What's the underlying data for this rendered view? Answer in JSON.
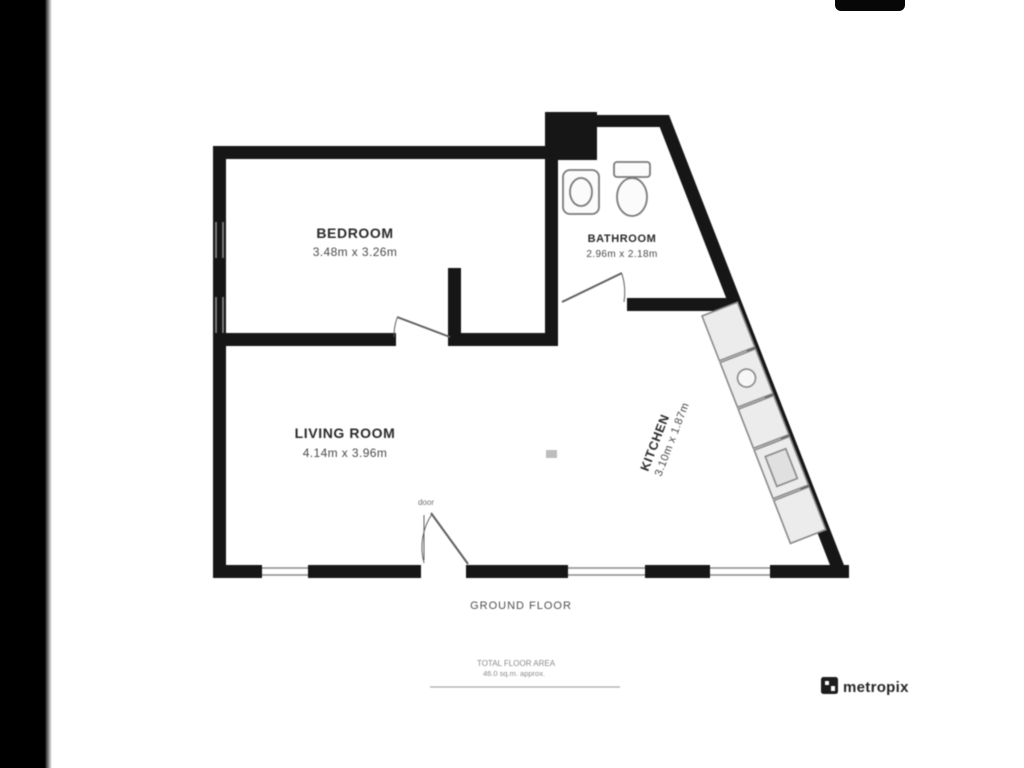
{
  "floorplan": {
    "rooms": [
      {
        "name": "BEDROOM",
        "dimensions": "3.48m x 3.26m"
      },
      {
        "name": "BATHROOM",
        "dimensions": "2.96m x 2.18m"
      },
      {
        "name": "LIVING ROOM",
        "dimensions": "4.14m x 3.96m"
      },
      {
        "name": "KITCHEN",
        "dimensions": "3.10m x 1.87m"
      }
    ],
    "door_label": "door",
    "floor_label": "GROUND FLOOR",
    "area_note_line1": "TOTAL FLOOR AREA",
    "area_note_line2": "46.0 sq.m. approx.",
    "brand": "metropix"
  },
  "colors": {
    "wall": "#161616",
    "fixture_line": "#7a7a7a",
    "window_line": "#8c8c8c",
    "letterbox": "#000000",
    "background": "#ffffff"
  }
}
